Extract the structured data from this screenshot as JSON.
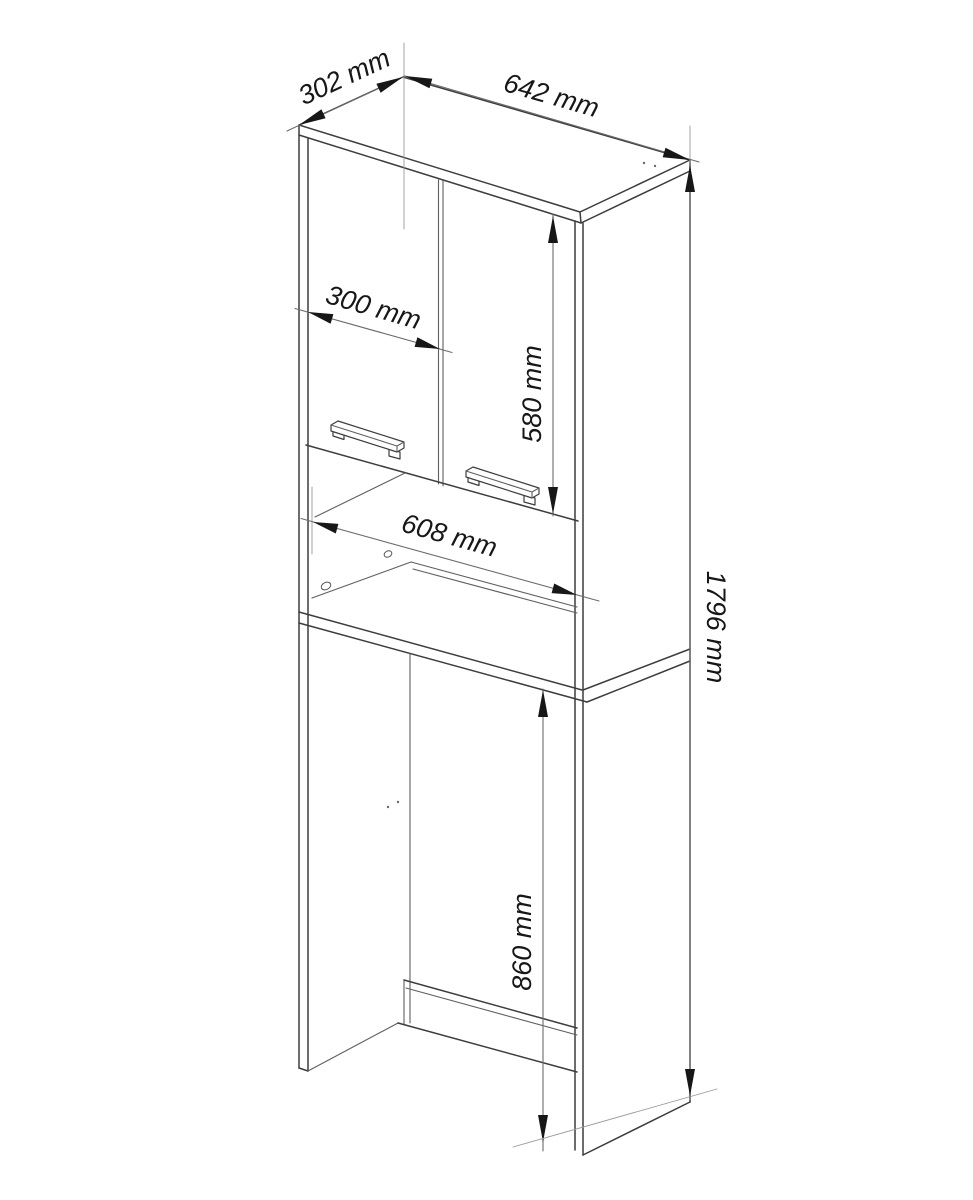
{
  "diagram": {
    "unit": "mm",
    "dimensions": {
      "depth": {
        "label": "302 mm",
        "value": 302
      },
      "width": {
        "label": "642 mm",
        "value": 642
      },
      "door_width": {
        "label": "300 mm",
        "value": 300
      },
      "door_height": {
        "label": "580 mm",
        "value": 580
      },
      "inner_width": {
        "label": "608 mm",
        "value": 608
      },
      "total_height": {
        "label": "1796 mm",
        "value": 1796
      },
      "niche_height": {
        "label": "860 mm",
        "value": 860
      }
    },
    "colors": {
      "background": "#ffffff",
      "edge_line": "#3d3d3d",
      "dimension_line": "#6b6b6b",
      "extension_line": "#9a9a9a",
      "text": "#171717"
    }
  }
}
